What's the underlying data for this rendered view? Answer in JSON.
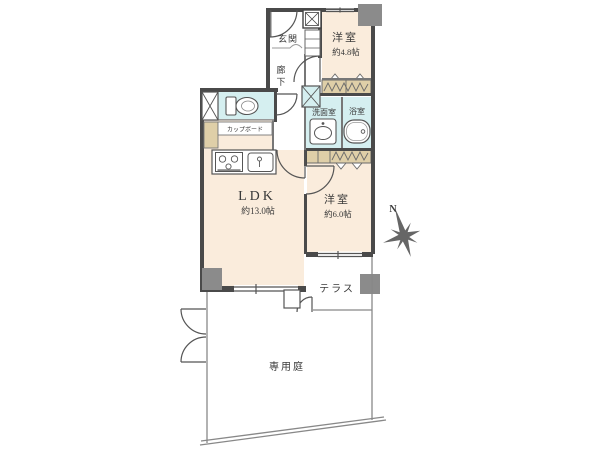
{
  "plan": {
    "rooms": {
      "genkan": {
        "label": "玄関"
      },
      "western_room_small": {
        "label": "洋室",
        "size": "約4.8帖"
      },
      "hallway": {
        "char1": "廊",
        "char2": "下"
      },
      "washroom": {
        "label": "洗面室"
      },
      "bathroom": {
        "label": "浴室"
      },
      "ldk": {
        "label": "LDK",
        "size": "約13.0帖"
      },
      "western_room_large": {
        "label": "洋室",
        "size": "約6.0帖"
      },
      "terrace": {
        "label": "テラス"
      },
      "private_garden": {
        "label": "専用庭"
      },
      "cupboard": {
        "label": "カップボード"
      }
    },
    "compass": {
      "north_label": "N"
    },
    "colors": {
      "room_cream": "#faecdc",
      "wet_area_blue": "#d5eff0",
      "closet_tan": "#dfcfa8",
      "wall": "#4a4a4a",
      "pillar": "#8b8b8b"
    }
  }
}
